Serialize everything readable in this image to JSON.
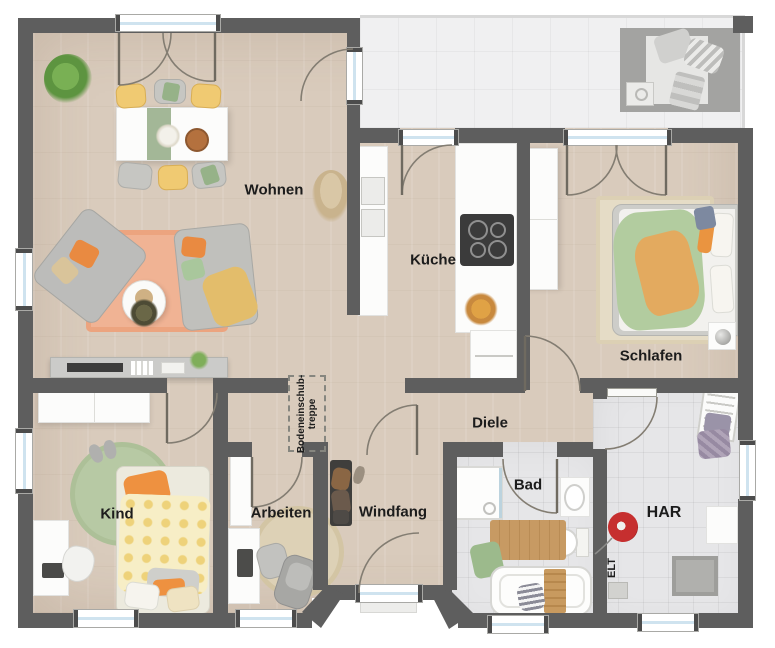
{
  "rooms": {
    "wohnen": {
      "label": "Wohnen"
    },
    "kueche": {
      "label": "Küche"
    },
    "schlafen": {
      "label": "Schlafen"
    },
    "diele": {
      "label": "Diele"
    },
    "kind": {
      "label": "Kind"
    },
    "arbeiten": {
      "label": "Arbeiten"
    },
    "windfang": {
      "label": "Windfang"
    },
    "bad": {
      "label": "Bad"
    },
    "har": {
      "label": "HAR"
    }
  },
  "annotations": {
    "attic_stairs_line1": "Bodeneinschub-",
    "attic_stairs_line2": "treppe",
    "elt_label": "ELT"
  },
  "palette": {
    "wall": "#5e5e5e",
    "wood_floor": "#d9cbbc",
    "tile_floor": "#e6e6e8",
    "terrace_tile": "#f0f0f1",
    "window_glass": "#cfe3ef",
    "accent_yellow": "#f0ca72",
    "accent_orange": "#e98a41",
    "accent_green": "#a9c79c",
    "accent_salmon": "#f0b394",
    "vacuum_red": "#c62f2f"
  }
}
